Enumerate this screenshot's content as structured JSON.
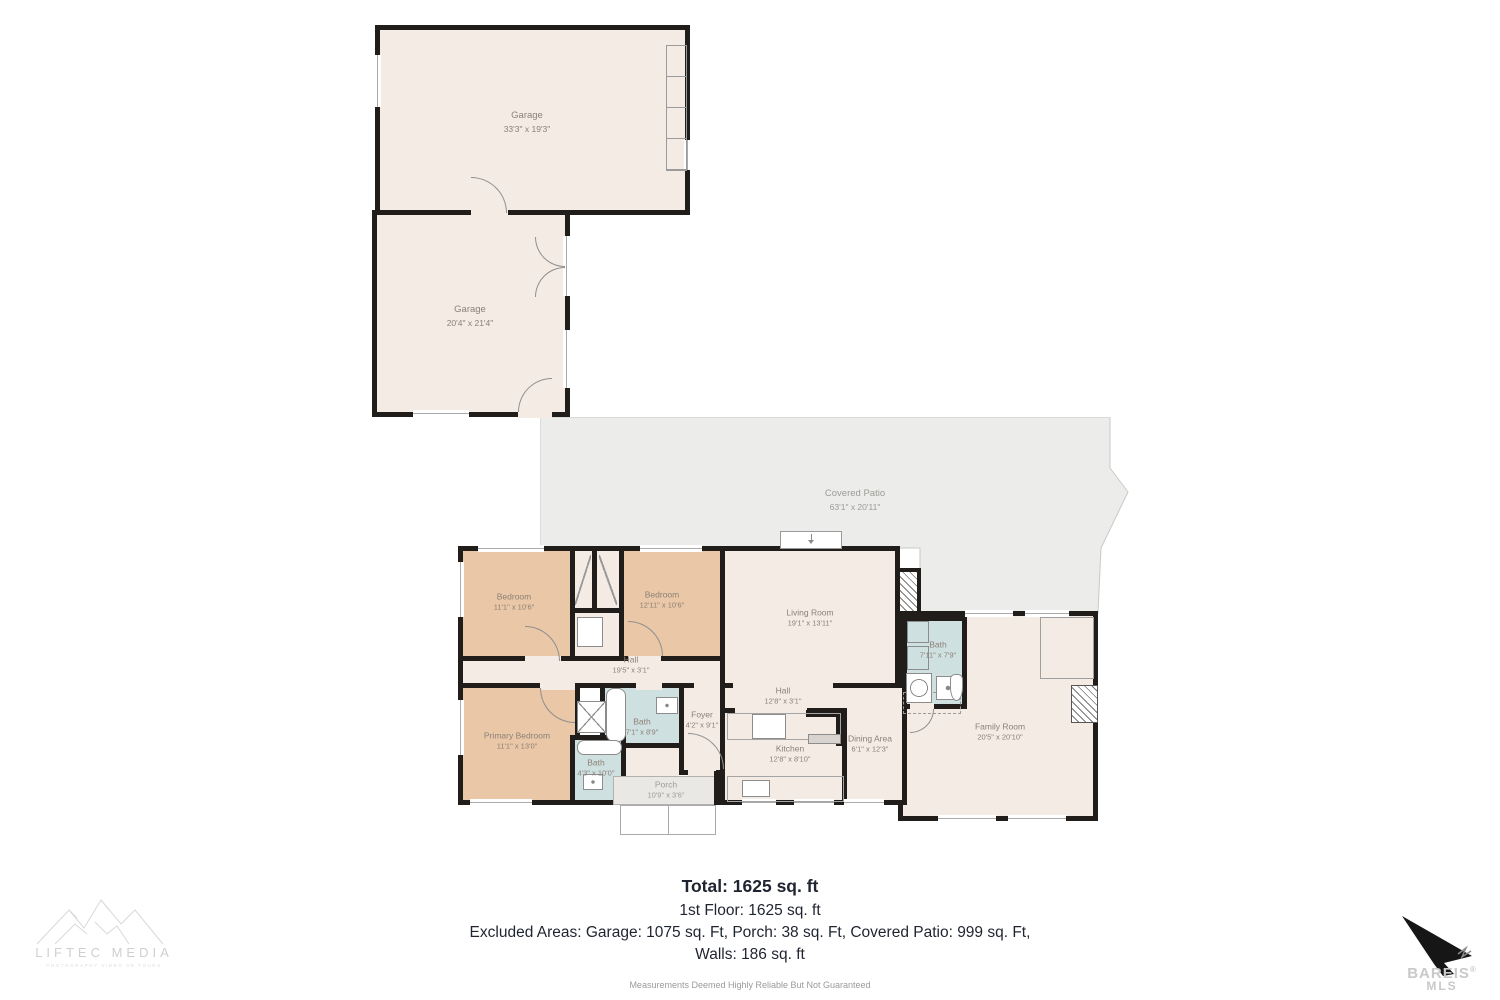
{
  "rooms": {
    "garage_upper": {
      "name": "Garage",
      "dims": "33'3\" x 19'3\""
    },
    "garage_lower": {
      "name": "Garage",
      "dims": "20'4\" x 21'4\""
    },
    "covered_patio": {
      "name": "Covered Patio",
      "dims": "63'1\" x 20'11\""
    },
    "bedroom_a": {
      "name": "Bedroom",
      "dims": "11'1\" x 10'6\""
    },
    "bedroom_b": {
      "name": "Bedroom",
      "dims": "12'11\" x 10'6\""
    },
    "living_room": {
      "name": "Living Room",
      "dims": "19'1\" x 13'11\""
    },
    "hall_a": {
      "name": "Hall",
      "dims": "19'5\" x 3'1\""
    },
    "primary_bedroom": {
      "name": "Primary Bedroom",
      "dims": "11'1\" x 13'0\""
    },
    "bath_a": {
      "name": "Bath",
      "dims": "7'1\" x 8'9\""
    },
    "bath_b": {
      "name": "Bath",
      "dims": "4'3\" x 10'0\""
    },
    "foyer": {
      "name": "Foyer",
      "dims": "4'2\" x 9'1\""
    },
    "hall_b": {
      "name": "Hall",
      "dims": "12'8\" x 3'1\""
    },
    "kitchen": {
      "name": "Kitchen",
      "dims": "12'8\" x 8'10\""
    },
    "dining_area": {
      "name": "Dining Area",
      "dims": "6'1\" x 12'3\""
    },
    "bath_c": {
      "name": "Bath",
      "dims": "7'11\" x 7'9\""
    },
    "family_room": {
      "name": "Family Room",
      "dims": "20'5\" x 20'10\""
    },
    "porch": {
      "name": "Porch",
      "dims": "10'9\" x 3'6\""
    }
  },
  "summary": {
    "total": "Total: 1625 sq. ft",
    "first_floor": "1st Floor: 1625 sq. ft",
    "excluded": "Excluded Areas: Garage: 1075 sq. Ft, Porch: 38 sq. Ft, Covered Patio: 999 sq. Ft,",
    "walls": "Walls: 186 sq. ft",
    "disclaimer": "Measurements Deemed Highly Reliable But Not Guaranteed"
  },
  "branding": {
    "media_name": "LIFTEC MEDIA",
    "media_tagline": "PHOTOGRAPHY   VIDEO   3D TOURS",
    "mls_name": "BAREIS",
    "mls_reg": "®",
    "mls_sub": "MLS"
  },
  "colors": {
    "wall": "#201d1b",
    "bedroom_fill": "#eac7a6",
    "bath_fill": "#cfe0e1",
    "floor_fill": "#f4ebe5",
    "patio_fill": "#ececea"
  }
}
